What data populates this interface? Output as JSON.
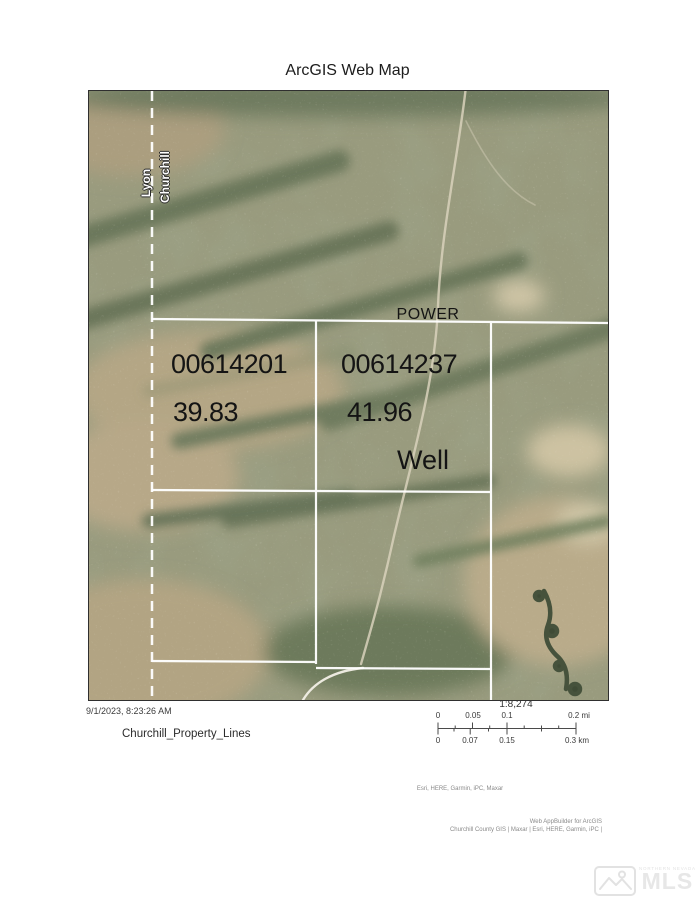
{
  "page": {
    "title": "ArcGIS Web Map"
  },
  "map": {
    "county_line": {
      "left_label": "Lyon",
      "right_label": "Churchill"
    },
    "power_label": "POWER",
    "well_label": "Well",
    "parcels": [
      {
        "number": "00614201",
        "acres": "39.83"
      },
      {
        "number": "00614237",
        "acres": "41.96"
      }
    ]
  },
  "footer": {
    "timestamp": "9/1/2023, 8:23:26 AM",
    "legend_title": "Churchill_Property_Lines",
    "scale_ratio": "1:8,274",
    "scale_mi": [
      "0",
      "0.05",
      "0.1",
      "0.2 mi"
    ],
    "scale_km": [
      "0",
      "0.07",
      "0.15",
      "0.3 km"
    ],
    "attribution_center": "Esri, HERE, Garmin, iPC, Maxar",
    "attribution_right_line1": "Web AppBuilder for ArcGIS",
    "attribution_right_line2": "Churchill County GIS | Maxar | Esri, HERE, Garmin, iPC |",
    "watermark_small": "NORTHERN NEVADA",
    "watermark_big": "MLS"
  },
  "colors": {
    "property_line": "#ffffff",
    "parcel_label_text": "#141414",
    "terrain_sage": "#999b7e",
    "terrain_tan": "#b4a685",
    "terrain_dark": "#6c785c"
  }
}
